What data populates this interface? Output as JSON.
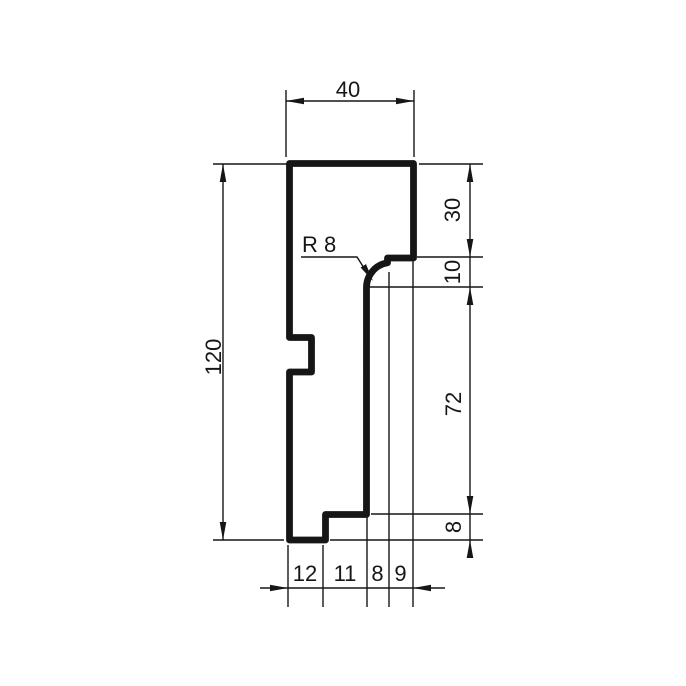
{
  "dimension_labels": {
    "top_width": "40",
    "overall_height": "120",
    "radius": "R 8",
    "right_chain": [
      "30",
      "10",
      "72",
      "8"
    ],
    "bottom_chain": [
      "12",
      "11",
      "8",
      "9"
    ]
  },
  "colors": {
    "line": "#161616",
    "background": "#ffffff"
  }
}
